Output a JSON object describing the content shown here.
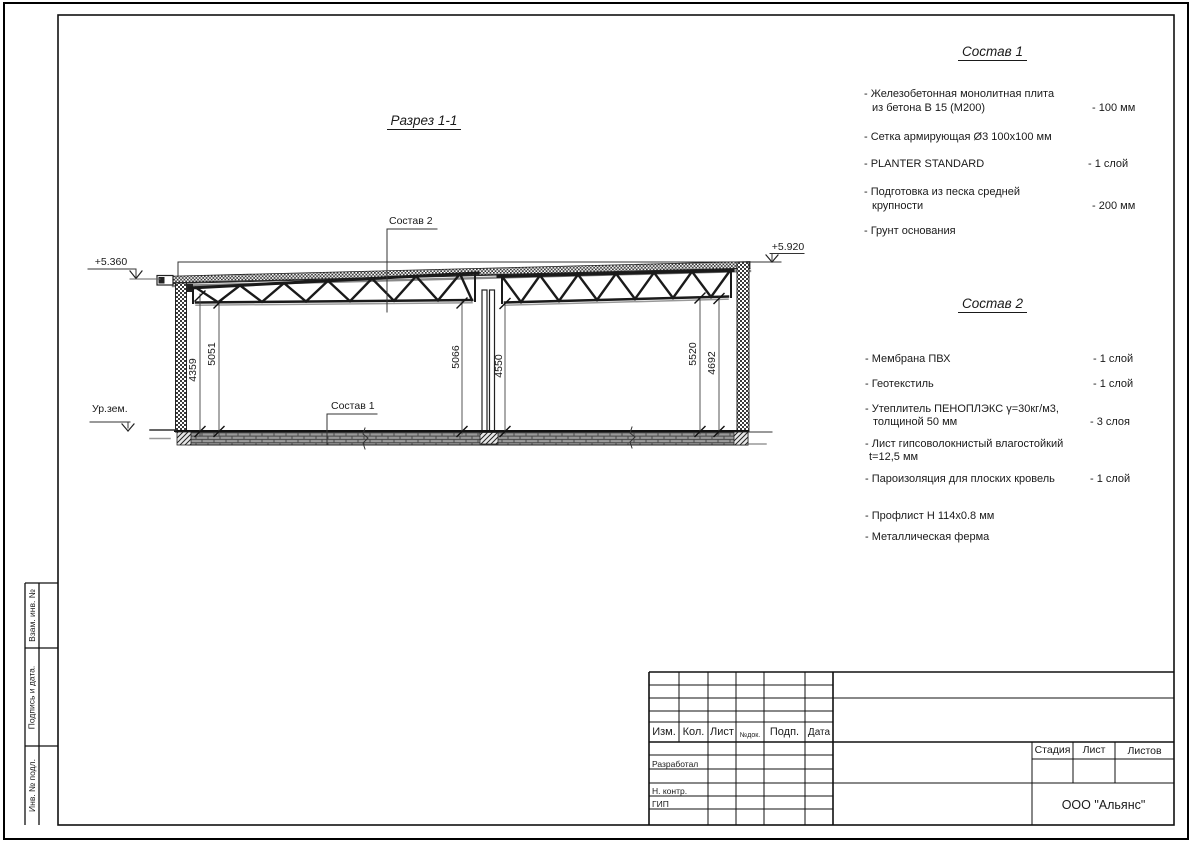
{
  "sheet": {
    "section_title": "Разрез 1-1",
    "labels": {
      "sostav2_ref": "Состав 2",
      "sostav1_ref": "Состав 1",
      "elev_left": "+5.360",
      "elev_right": "+5.920",
      "ground": "Ур.зем."
    },
    "dims": [
      "4359",
      "5051",
      "5066",
      "4550",
      "5520",
      "4692"
    ]
  },
  "s1": {
    "title": "Состав 1",
    "items": [
      {
        "l1": "- Железобетонная  монолитная плита",
        "l2": "из бетона В 15 (М200)",
        "val": "- 100 мм"
      },
      {
        "l1": "- Сетка армирующая Ø3 100х100 мм"
      },
      {
        "l1": "- PLANTER STANDARD",
        "val": "- 1  слой"
      },
      {
        "l1": "- Подготовка из песка средней",
        "l2": "крупности",
        "val": "- 200 мм"
      },
      {
        "l1": "- Грунт основания"
      }
    ]
  },
  "s2": {
    "title": "Состав 2",
    "items": [
      {
        "l1": "- Мембрана ПВХ",
        "val": "- 1 слой"
      },
      {
        "l1": "- Геотекстиль",
        "val": "- 1 слой"
      },
      {
        "l1": "- Утеплитель ПЕНОПЛЭКС γ=30кг/м3,",
        "l2": "толщиной 50 мм",
        "val": "- 3 слоя"
      },
      {
        "l1": "- Лист гипсоволокнистый влагостойкий",
        "l2": "t=12,5 мм"
      },
      {
        "l1": "- Пароизоляция для плоских кровель",
        "val": "- 1 слой"
      },
      {
        "l1": "- Профлист Н 114х0.8 мм"
      },
      {
        "l1": "- Металлическая ферма"
      }
    ]
  },
  "titleblock": {
    "cols": [
      "Изм.",
      "Кол.",
      "Лист",
      "№док.",
      "Подп.",
      "Дата"
    ],
    "roles": [
      "Разработал",
      "Н. контр.",
      "ГИП"
    ],
    "stage_cols": [
      "Стадия",
      "Лист",
      "Листов"
    ],
    "org": "ООО \"Альянс\""
  },
  "sidebar": [
    "Взам. инв. №",
    "Подпись  и  дата.",
    "Инв. № подл."
  ]
}
